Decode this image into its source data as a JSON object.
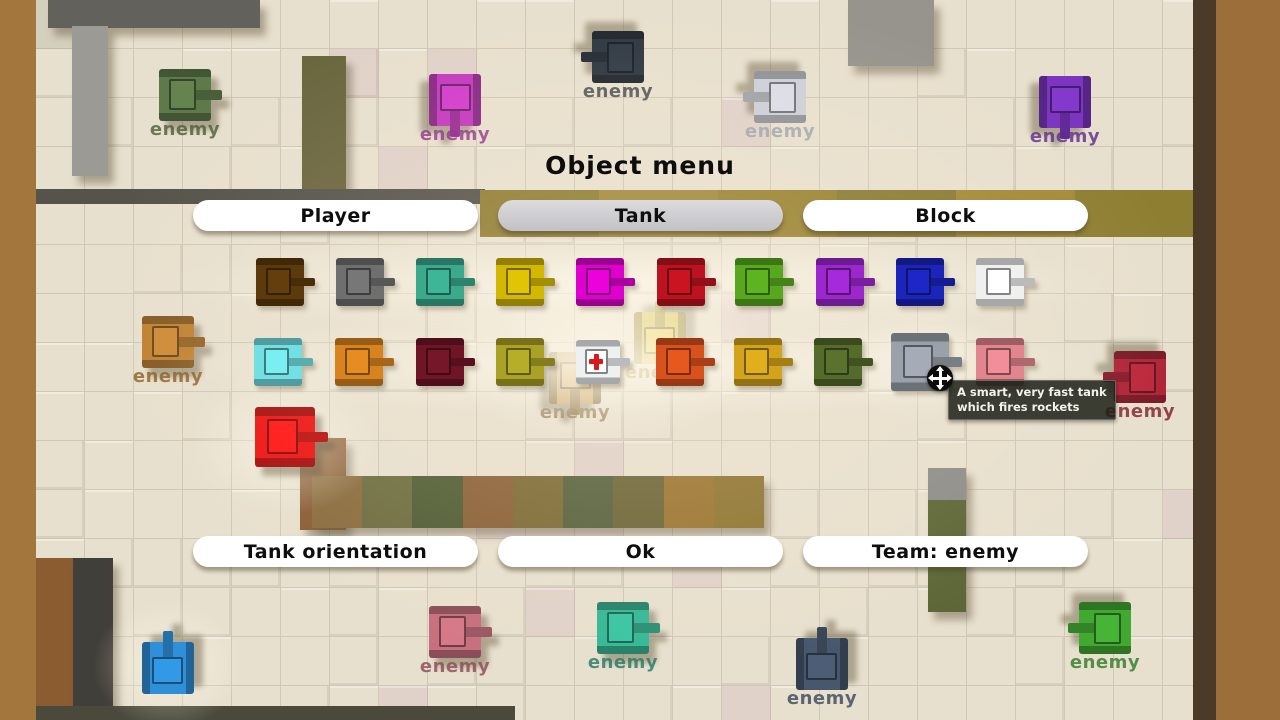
{
  "menu": {
    "title": "Object menu",
    "top_buttons": [
      {
        "id": "player",
        "label": "Player",
        "selected": false
      },
      {
        "id": "tank",
        "label": "Tank",
        "selected": true
      },
      {
        "id": "block",
        "label": "Block",
        "selected": false
      }
    ],
    "bottom_buttons": [
      {
        "id": "tank-orientation",
        "label": "Tank orientation"
      },
      {
        "id": "ok",
        "label": "Ok"
      },
      {
        "id": "team",
        "label": "Team: enemy"
      }
    ],
    "tooltip": {
      "line1": "A smart, very fast tank",
      "line2": "which fires rockets"
    },
    "cursor": {
      "x": 940,
      "y": 378
    },
    "tank_options": {
      "row1_y": 282,
      "row2_y": 362,
      "row1": [
        {
          "x": 280,
          "color": "#5d3a0b",
          "name": "brown"
        },
        {
          "x": 360,
          "color": "#6f6f6f",
          "name": "gray"
        },
        {
          "x": 440,
          "color": "#3aa98c",
          "name": "teal"
        },
        {
          "x": 520,
          "color": "#d2b703",
          "name": "yellow"
        },
        {
          "x": 600,
          "color": "#dd00ce",
          "name": "magenta"
        },
        {
          "x": 681,
          "color": "#bd1320",
          "name": "red"
        },
        {
          "x": 759,
          "color": "#57a81e",
          "name": "green"
        },
        {
          "x": 840,
          "color": "#9b27cd",
          "name": "purple"
        },
        {
          "x": 920,
          "color": "#1b24bb",
          "name": "blue"
        },
        {
          "x": 1000,
          "color": "#f0f0f0",
          "name": "white"
        }
      ],
      "row2": [
        {
          "x": 278,
          "color": "#72dfe2",
          "name": "cyan"
        },
        {
          "x": 359,
          "color": "#d8831f",
          "name": "orange"
        },
        {
          "x": 440,
          "color": "#6f1525",
          "name": "maroon"
        },
        {
          "x": 520,
          "color": "#aaa226",
          "name": "olive"
        },
        {
          "x": 598,
          "color": "#eef0f2",
          "name": "medic",
          "cross": true,
          "size": 44
        },
        {
          "x": 680,
          "color": "#d8521d",
          "name": "orange-red"
        },
        {
          "x": 758,
          "color": "#d2a31b",
          "name": "gold"
        },
        {
          "x": 838,
          "color": "#556b2b",
          "name": "dark-green"
        },
        {
          "x": 920,
          "color": "#9aa1ab",
          "name": "smart-rocket",
          "size": 58,
          "hovered": true
        },
        {
          "x": 1000,
          "color": "#e2858e",
          "name": "pink"
        }
      ]
    }
  },
  "map": {
    "enemy_label": "enemy",
    "tanks": [
      {
        "x": 185,
        "y": 95,
        "color": "#5e7a4a",
        "dir": "right",
        "name": "dark-green",
        "label": true,
        "label_color": "#4c5e3a"
      },
      {
        "x": 455,
        "y": 100,
        "color": "#c437be",
        "dir": "down",
        "name": "magenta",
        "label": true,
        "label_color": "#8c2a88"
      },
      {
        "x": 618,
        "y": 57,
        "color": "#2c3540",
        "dir": "left",
        "name": "dark-navy",
        "label": true,
        "label_color": "#3a3f46"
      },
      {
        "x": 780,
        "y": 97,
        "color": "#ccd0d8",
        "dir": "left",
        "name": "silver",
        "label": true,
        "label_color": "#9aa0ac"
      },
      {
        "x": 1065,
        "y": 102,
        "color": "#7b35c0",
        "dir": "down",
        "name": "purple",
        "label": true,
        "label_color": "#5c2a8a"
      },
      {
        "x": 168,
        "y": 342,
        "color": "#c08233",
        "dir": "right",
        "name": "tan-orange",
        "label": true,
        "label_color": "#8a5c20"
      },
      {
        "x": 575,
        "y": 378,
        "color": "#c8a668",
        "dir": "down",
        "name": "tan",
        "label": true,
        "label_color": "#8a734a"
      },
      {
        "x": 660,
        "y": 338,
        "color": "#d8c248",
        "dir": "up",
        "name": "yellow",
        "label": true,
        "label_color": "#9a8830"
      },
      {
        "x": 1140,
        "y": 377,
        "color": "#b02438",
        "dir": "left",
        "name": "dark-red",
        "label": true,
        "label_color": "#7c1a28"
      },
      {
        "x": 285,
        "y": 437,
        "color": "#ee1413",
        "dir": "right",
        "name": "red",
        "label": false,
        "size": 60
      },
      {
        "x": 168,
        "y": 668,
        "color": "#2f8fd8",
        "dir": "up",
        "name": "blue",
        "label": false,
        "size": 52
      },
      {
        "x": 455,
        "y": 632,
        "color": "#c76f7e",
        "dir": "right",
        "name": "pink",
        "label": true,
        "label_color": "#8a4a56"
      },
      {
        "x": 623,
        "y": 628,
        "color": "#35b896",
        "dir": "right",
        "name": "teal",
        "label": true,
        "label_color": "#1f7a62"
      },
      {
        "x": 822,
        "y": 664,
        "color": "#47586e",
        "dir": "up",
        "name": "slate",
        "label": true,
        "label_color": "#39465a"
      },
      {
        "x": 1105,
        "y": 628,
        "color": "#41a832",
        "dir": "left",
        "name": "green",
        "label": true,
        "label_color": "#2d7a22"
      }
    ],
    "walls": [
      {
        "id": "top-left-strip",
        "x": 48,
        "y": 0,
        "w": 212,
        "h": 28,
        "color": "#62615c",
        "shadow": true
      },
      {
        "id": "left-gray-column",
        "x": 72,
        "y": 26,
        "w": 36,
        "h": 150,
        "color": "#9b9a94",
        "shadow": true
      },
      {
        "id": "olive-column",
        "x": 302,
        "y": 56,
        "w": 44,
        "h": 136,
        "color": "#6a663e",
        "shadow": true
      },
      {
        "id": "thin-dark-strip",
        "x": 35,
        "y": 189,
        "w": 450,
        "h": 15,
        "color": "#55534a"
      },
      {
        "id": "gold-band",
        "x": 480,
        "y": 190,
        "w": 714,
        "h": 47,
        "blocks": [
          "#8e7c30",
          "#a08838",
          "#97822f",
          "#8a7a33",
          "#a38a36",
          "#8e7e31"
        ]
      },
      {
        "id": "brown-column",
        "x": 300,
        "y": 438,
        "w": 46,
        "h": 92,
        "color": "#8a5e36",
        "shadow": true
      },
      {
        "id": "center-wall",
        "x": 312,
        "y": 476,
        "w": 452,
        "h": 52,
        "shadow": true,
        "blocks": [
          "#8a6c3e",
          "#6d6d3f",
          "#4f5c33",
          "#8a5f35",
          "#7b6a33",
          "#55603a",
          "#6b6435",
          "#99742e",
          "#8d7430"
        ]
      },
      {
        "id": "right-wall-cap",
        "x": 928,
        "y": 468,
        "w": 38,
        "h": 32,
        "color": "#8d8d89",
        "shadow": true
      },
      {
        "id": "right-wall",
        "x": 928,
        "y": 500,
        "w": 38,
        "h": 112,
        "color": "#5d6636",
        "shadow": true
      },
      {
        "id": "top-mid-gray",
        "x": 848,
        "y": 0,
        "w": 86,
        "h": 66,
        "color": "#96948c",
        "shadow": true
      },
      {
        "id": "right-dark-strip",
        "x": 1193,
        "y": 0,
        "w": 24,
        "h": 720,
        "color": "#4b3a27"
      },
      {
        "id": "bottom-left-brown",
        "x": 35,
        "y": 558,
        "w": 38,
        "h": 162,
        "color": "#8a5c30"
      },
      {
        "id": "bottom-left-dark",
        "x": 73,
        "y": 558,
        "w": 40,
        "h": 162,
        "color": "#413f39",
        "shadow": true
      },
      {
        "id": "bottom-strip",
        "x": 35,
        "y": 706,
        "w": 480,
        "h": 14,
        "color": "#4a493b"
      },
      {
        "id": "left-border",
        "x": 0,
        "y": 0,
        "w": 36,
        "h": 720,
        "color": "#a3763e"
      },
      {
        "id": "right-border",
        "x": 1216,
        "y": 0,
        "w": 64,
        "h": 720,
        "color": "#9c6f3a"
      }
    ],
    "glows": [
      {
        "x": 285,
        "y": 440,
        "w": 190,
        "h": 150,
        "a": 0.5,
        "layer": "under"
      },
      {
        "x": 168,
        "y": 665,
        "w": 150,
        "h": 130,
        "a": 0.45,
        "layer": "under"
      },
      {
        "x": 640,
        "y": 283,
        "w": 950,
        "h": 105,
        "a": 0.7,
        "layer": "over"
      },
      {
        "x": 640,
        "y": 363,
        "w": 950,
        "h": 105,
        "a": 0.65,
        "layer": "over"
      },
      {
        "x": 600,
        "y": 345,
        "w": 320,
        "h": 200,
        "a": 0.55,
        "layer": "over"
      },
      {
        "x": 920,
        "y": 362,
        "w": 170,
        "h": 120,
        "a": 0.45,
        "layer": "over"
      }
    ],
    "floor_palette": [
      "#e8e0ce",
      "#ded4c0",
      "#e5dccb",
      "#d9d0ba",
      "#e2d7c8",
      "#d2cab6",
      "#e9e1d6",
      "#ddd6c4",
      "#e0d2c8",
      "#e6dbc4",
      "#d8d4bc",
      "#e4d4cf",
      "#dcd8c6",
      "#e1d9c2",
      "#d5cfbd",
      "#e7ded2"
    ]
  },
  "colors": {
    "button_bg": "#ffffff",
    "button_selected": "#c8c8cc",
    "tooltip_bg": "rgba(28,30,22,0.85)",
    "tooltip_text": "#f2f2ea",
    "title_color": "#0d0d0d",
    "cursor_bg": "#0c0c0c"
  }
}
